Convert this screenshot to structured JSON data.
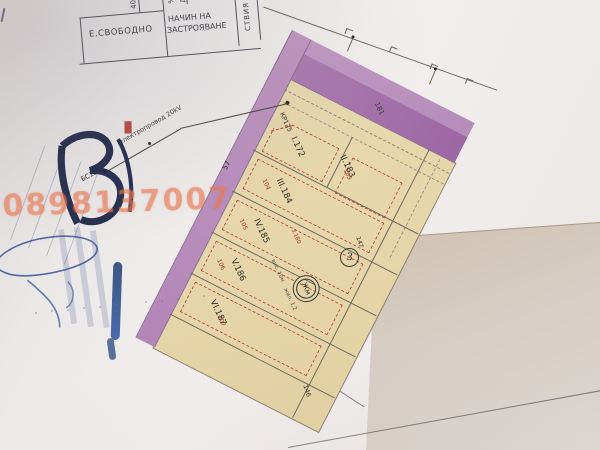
{
  "photo": {
    "watermark": "0898137007"
  },
  "table": {
    "cell_free": "Е.СВОБОДНО",
    "cell_method_line1": "НАЧИН НА",
    "cell_method_line2": "ЗАСТРОЯВАНЕ",
    "header_40": "40",
    "header_pct": "%",
    "header_dka": "Дка",
    "side_fragment": "СТВИЯ"
  },
  "plan": {
    "street_number": "181",
    "block_number": "3",
    "left_number": "57",
    "bottom_number": "146",
    "corner_number": "147",
    "zone_symbol": "Жм",
    "zone_note_height": "вис. 10м",
    "zone_note_dwell": "жил. 1,2",
    "point_kr": "КР125",
    "point_bs": "БС124",
    "powerline_label": "електропровод 20kV",
    "dim_note": "3.180",
    "parcels": [
      {
        "id": "I.172",
        "old": ""
      },
      {
        "id": "II.183",
        "old": "103"
      },
      {
        "id": "III.184",
        "old": "104"
      },
      {
        "id": "IV.185",
        "old": "105"
      },
      {
        "id": "V.186",
        "old": "106"
      },
      {
        "id": "VI.187",
        "old": "107"
      }
    ]
  },
  "colors": {
    "street_purple": "#b98fbd",
    "street_purple_dark": "#9d66a3",
    "parcel_tan": "#e7d6aa",
    "red_dash": "#b6403d",
    "watermark_orange": "#e87a50",
    "pen_blue": "#2c4a8f",
    "logo_navy": "#1e2748"
  }
}
